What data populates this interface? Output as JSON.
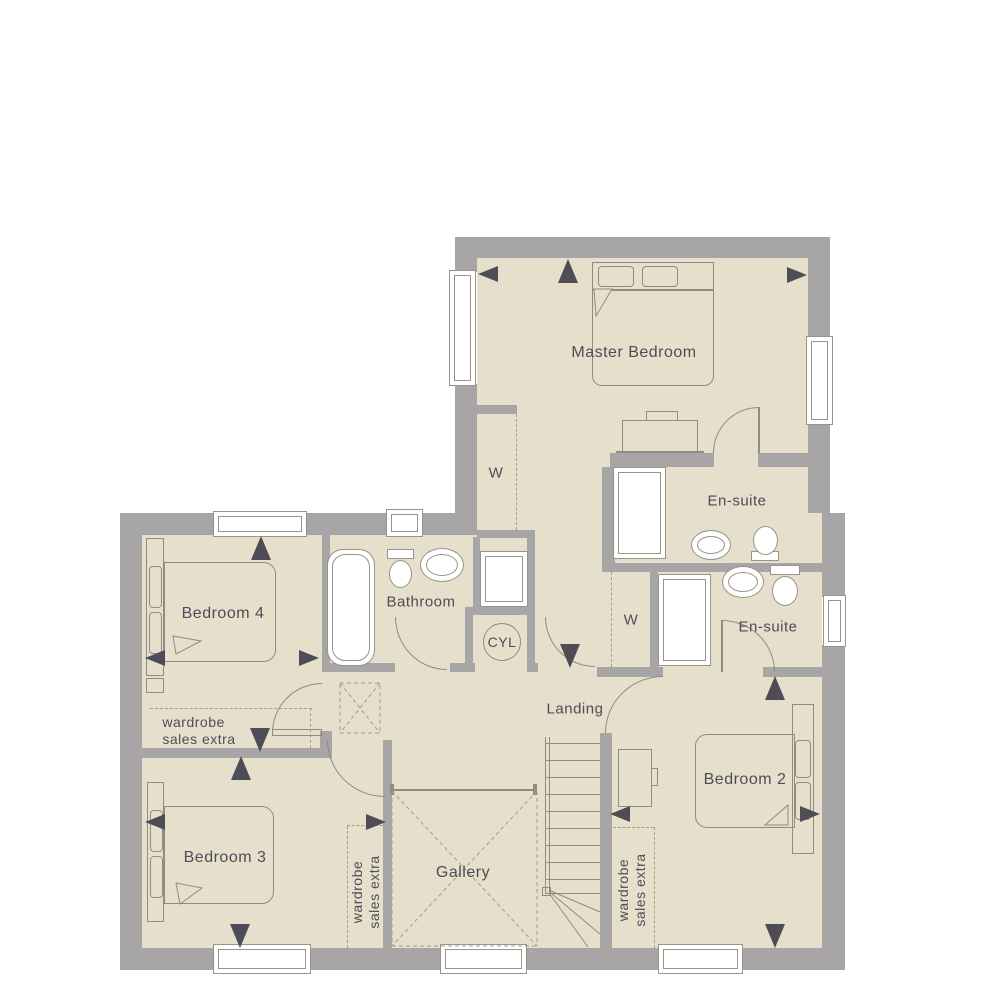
{
  "plan": {
    "title": "First floor plan",
    "rooms": {
      "master_bedroom": "Master Bedroom",
      "ensuite_master": "En-suite",
      "ensuite_2": "En-suite",
      "bathroom": "Bathroom",
      "landing": "Landing",
      "gallery": "Gallery",
      "bedroom_2": "Bedroom 2",
      "bedroom_3": "Bedroom 3",
      "bedroom_4": "Bedroom 4"
    },
    "labels": {
      "wardrobe_letter": "W",
      "cylinder": "CYL",
      "wardrobe_note_line1": "wardrobe",
      "wardrobe_note_line2": "sales extra"
    },
    "fixtures": [
      "bed",
      "bath",
      "shower",
      "basin",
      "toilet",
      "dresser",
      "desk",
      "stairs",
      "cylinder-cupboard",
      "wardrobe"
    ],
    "colors": {
      "floor": "#e6dfcc",
      "wall": "#a7a5a6",
      "furniture_line": "#908c81",
      "dashed_line": "#a29d8e",
      "text_and_arrows": "#4e4d55",
      "fixture_fill": "#ffffff",
      "background": "#ffffff"
    }
  }
}
